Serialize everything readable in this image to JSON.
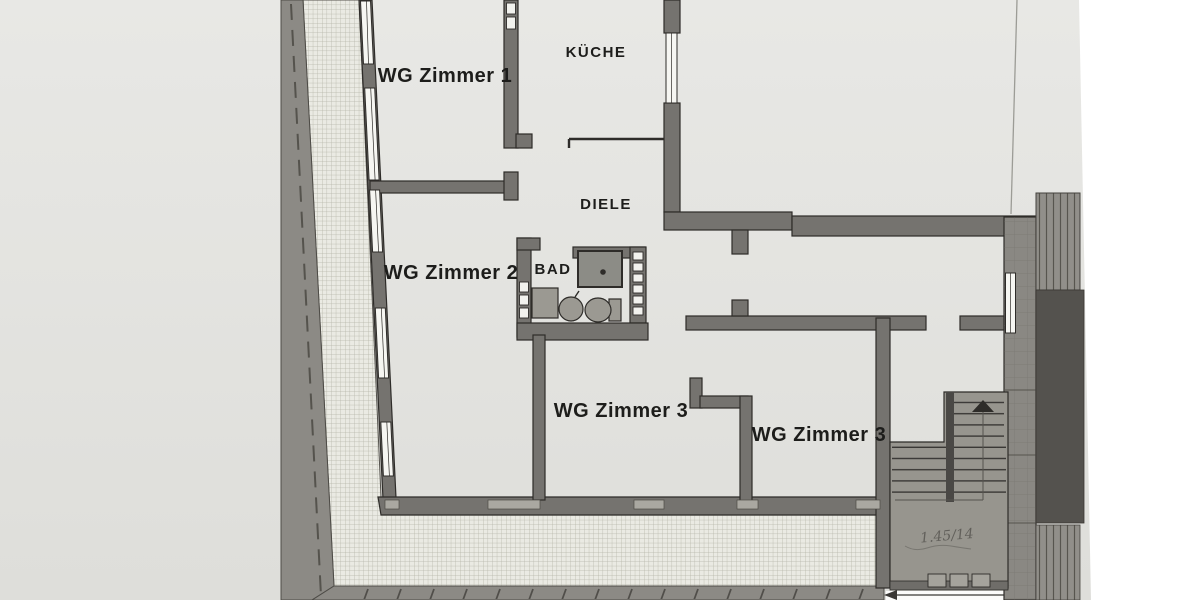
{
  "floor_plan": {
    "rooms": [
      {
        "name": "wg-zimmer-1",
        "label": "WG Zimmer 1"
      },
      {
        "name": "kueche",
        "label": "KÜCHE"
      },
      {
        "name": "diele",
        "label": "DIELE"
      },
      {
        "name": "wg-zimmer-2",
        "label": "WG Zimmer 2"
      },
      {
        "name": "bad",
        "label": "BAD"
      },
      {
        "name": "wg-zimmer-3-left",
        "label": "WG Zimmer 3"
      },
      {
        "name": "wg-zimmer-3-right",
        "label": "WG Zimmer 3"
      }
    ],
    "handwritten_note": "1.45/14",
    "fixtures": [
      "shower",
      "washbasin",
      "toilet",
      "washing-machine",
      "staircase"
    ],
    "colors": {
      "page_background": "#ffffff",
      "paper": "#e4e4e1",
      "wall": "#75736f",
      "wall_outline": "#2e2c29",
      "hatch_background": "#eaeae3",
      "hatch_line": "#b3b3a6",
      "outer_band": "#8c8a85",
      "dark_block": "#54524e",
      "stair_fill": "#97958e"
    }
  }
}
